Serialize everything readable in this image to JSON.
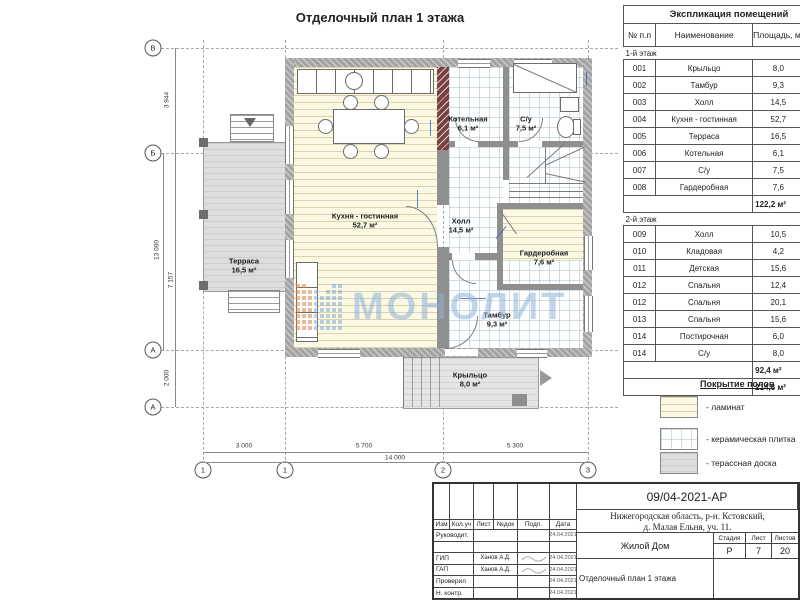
{
  "plan": {
    "title": "Отделочный план 1 этажа",
    "rooms": [
      {
        "name": "Кухня - гостинная",
        "area": "52,7 м²"
      },
      {
        "name": "Котельная",
        "area": "6,1 м²"
      },
      {
        "name": "С/у",
        "area": "7,5 м²"
      },
      {
        "name": "Холл",
        "area": "14,5 м²"
      },
      {
        "name": "Гардеробная",
        "area": "7,6 м²"
      },
      {
        "name": "Тамбур",
        "area": "9,3 м²"
      },
      {
        "name": "Терраса",
        "area": "16,5 м²"
      },
      {
        "name": "Крыльцо",
        "area": "8,0 м²"
      }
    ],
    "axes": {
      "rows": [
        "В",
        "Б",
        "А",
        "А"
      ],
      "cols": [
        "1",
        "1",
        "2",
        "3"
      ]
    },
    "dimensions": {
      "left": [
        "3 944",
        "13 000",
        "7 157",
        "2 000"
      ],
      "bottom": [
        "3 000",
        "5 700",
        "5 300"
      ],
      "bottom_total": "14 000"
    }
  },
  "watermark": {
    "text": "МОНОЛИТ",
    "color": "#8fb3da",
    "dot_orange": "#e0823f",
    "dot_blue": "#85abd8"
  },
  "explication": {
    "title": "Экспликация помещений",
    "columns": [
      "№ п.п",
      "Наименование",
      "Площадь, м²"
    ],
    "sections": [
      {
        "label": "1-й этаж",
        "rows": [
          [
            "001",
            "Крыльцо",
            "8,0"
          ],
          [
            "002",
            "Тамбур",
            "9,3"
          ],
          [
            "003",
            "Холл",
            "14,5"
          ],
          [
            "004",
            "Кухня - гостинная",
            "52,7"
          ],
          [
            "005",
            "Терраса",
            "16,5"
          ],
          [
            "006",
            "Котельная",
            "6,1"
          ],
          [
            "007",
            "С/у",
            "7,5"
          ],
          [
            "008",
            "Гардеробная",
            "7,6"
          ]
        ],
        "total": "122,2 м²"
      },
      {
        "label": "2-й этаж",
        "rows": [
          [
            "009",
            "Холл",
            "10,5"
          ],
          [
            "010",
            "Кладовая",
            "4,2"
          ],
          [
            "011",
            "Детская",
            "15,6"
          ],
          [
            "012",
            "Спальня",
            "12,4"
          ],
          [
            "012",
            "Спальня",
            "20,1"
          ],
          [
            "013",
            "Спальня",
            "15,6"
          ],
          [
            "014",
            "Постирочная",
            "6,0"
          ],
          [
            "014",
            "С/у",
            "8,0"
          ]
        ],
        "total": "92,4 м²"
      }
    ],
    "grand_total": "214,6 м²"
  },
  "legend": {
    "title": "Покрытие полов",
    "items": [
      {
        "label": "- ламинат",
        "type": "laminate"
      },
      {
        "label": "- керамическая плитка",
        "type": "tile"
      },
      {
        "label": "- терассная доска",
        "type": "deck"
      }
    ]
  },
  "stamp": {
    "doc_number": "09/04-2021-АР",
    "address_line1": "Нижегородская область, р-н. Кстовский,",
    "address_line2": "д. Малая Ельня, уч. 11.",
    "object_name": "Жилой Дом",
    "sheet_title": "Отделочный план 1 этажа",
    "stage_label": "Стадия",
    "sheet_label": "Лист",
    "sheets_label": "Листов",
    "stage": "Р",
    "sheet": "7",
    "sheets": "20",
    "header_cols": [
      "Изм",
      "Кол.уч",
      "Лист",
      "№док",
      "Подп.",
      "Дата"
    ],
    "rows": [
      {
        "role": "Руководит.",
        "name": "",
        "date": "24.04.2021"
      },
      {
        "role": "",
        "name": "",
        "date": ""
      },
      {
        "role": "ГИП",
        "name": "Ханов А.Д.",
        "date": "24.04.2021"
      },
      {
        "role": "ГАП",
        "name": "Ханов А.Д.",
        "date": "24.04.2021"
      },
      {
        "role": "Проверил",
        "name": "",
        "date": "24.04.2021"
      },
      {
        "role": "Н. контр.",
        "name": "",
        "date": "24.04.2021"
      }
    ]
  }
}
